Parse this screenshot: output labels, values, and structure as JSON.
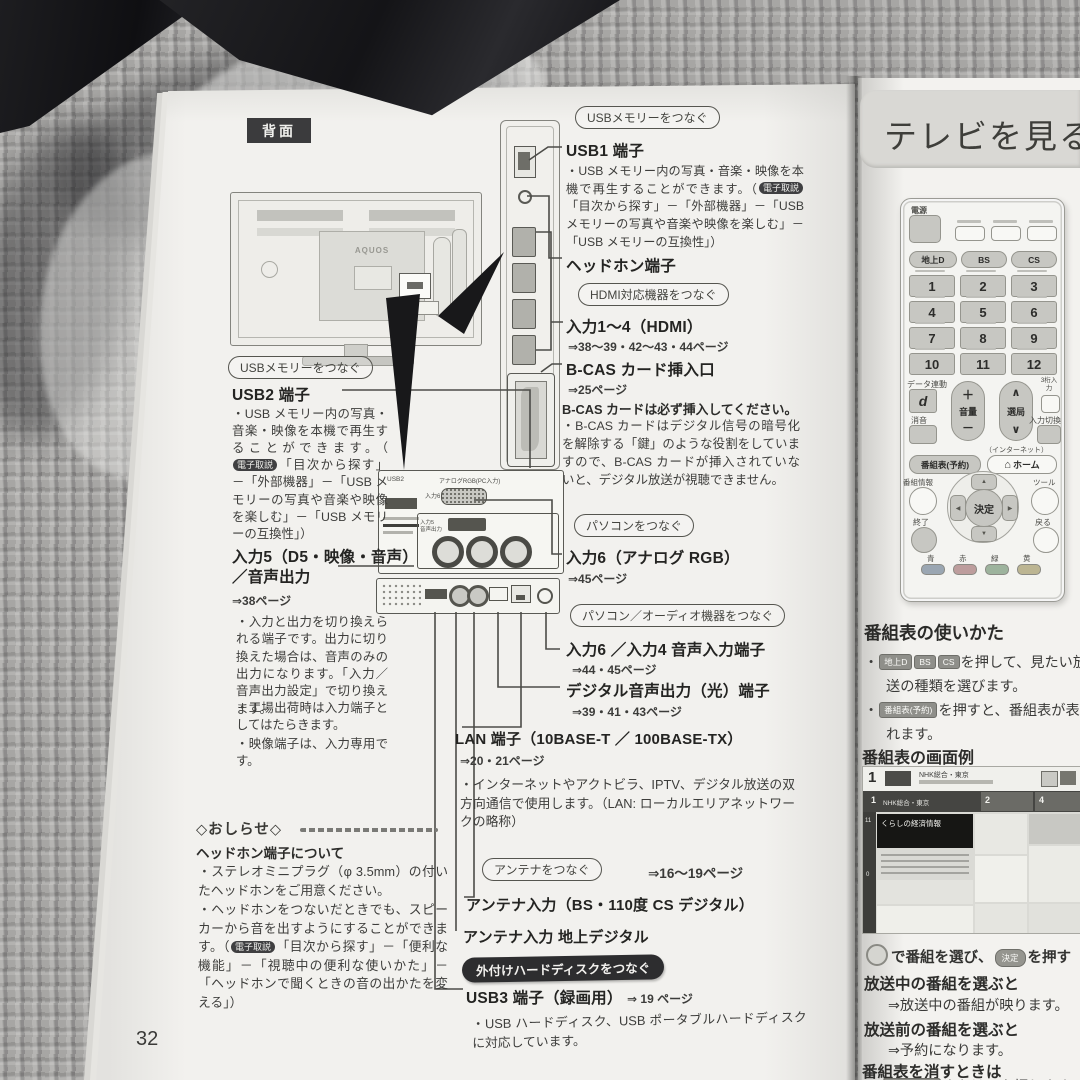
{
  "left": {
    "page_number": "32",
    "back_label": "背面",
    "tv_brand": "AQUOS",
    "ebadge": "電子取説",
    "cap_usb_right": "USBメモリーをつなぐ",
    "usb1_title": "USB1 端子",
    "usb1_pre": "・USB メモリー内の写真・音楽・映像を本機で再生することができます。（",
    "usb1_post": "「目次から探す」－「外部機器」－「USB メモリーの写真や音楽や映像を楽しむ」－「USB メモリーの互換性」）",
    "headphone_title": "ヘッドホン端子",
    "cap_hdmi": "HDMI対応機器をつなぐ",
    "hdmi_title": "入力1～4（HDMI）",
    "hdmi_pages": "⇒38～39・42～43・44ページ",
    "bcas_title": "B-CAS カード挿入口",
    "bcas_pages": "⇒25ページ",
    "bcas_warn": "B-CAS カードは必ず挿入してください。",
    "bcas_note": "・B-CAS カードはデジタル信号の暗号化を解除する「鍵」のような役割をしていますので、B-CAS カードが挿入されていないと、デジタル放送が視聴できません。",
    "cap_pc": "パソコンをつなぐ",
    "in6rgb_title": "入力6（アナログ RGB）",
    "in6rgb_pages": "⇒45ページ",
    "cap_pc_audio": "パソコン／オーディオ機器をつなぐ",
    "in6audio_title": "入力6 ／入力4 音声入力端子",
    "in6audio_pages": "⇒44・45ページ",
    "dig_title": "デジタル音声出力（光）端子",
    "dig_pages": "⇒39・41・43ページ",
    "lan_title": "LAN 端子（10BASE-T ／ 100BASE-TX）",
    "lan_pages": "⇒20・21ページ",
    "lan_note": "・インターネットやアクトビラ、IPTV、デジタル放送の双方向通信で使用します。（LAN: ローカルエリアネットワークの略称）",
    "cap_antenna": "アンテナをつなぐ",
    "antenna_pages": "⇒16～19ページ",
    "antenna_bs": "アンテナ入力（BS・110度 CS デジタル）",
    "antenna_ground": "アンテナ入力 地上デジタル",
    "cap_hdd": "外付けハードディスクをつなぐ",
    "usb3_title": "USB3 端子（録画用）",
    "usb3_pages": "⇒ 19 ページ",
    "usb3_note": "・USB ハードディスク、USB ポータブルハードディスクに対応しています。",
    "cap_usb_left": "USBメモリーをつなぐ",
    "usb2_title": "USB2 端子",
    "usb2_pre": "・USB メモリー内の写真・音楽・映像を本機で再生することができます。（",
    "usb2_post": "「目次から探す」－「外部機器」－「USB メモリーの写真や音楽や映像を楽しむ」－「USB メモリーの互換性」）",
    "in5_title": "入力5（D5・映像・音声）／音声出力",
    "in5_pages": "⇒38ページ",
    "in5_note1": "・入力と出力を切り換えられる端子です。出力に切り換えた場合は、音声のみの出力になります。「入力／音声出力設定」で切り換えます。",
    "in5_note2": "・工場出荷時は入力端子としてはたらきます。",
    "in5_note3": "・映像端子は、入力専用です。",
    "notice_title": "◇おしらせ◇",
    "notice_sub": "ヘッドホン端子について",
    "notice_1": "・ステレオミニプラグ（φ 3.5mm）の付いたヘッドホンをご用意ください。",
    "notice_2_pre": "・ヘッドホンをつないだときでも、スピーカーから音を出すようにすることができます。（",
    "notice_2_post": "「目次から探す」－「便利な機能」－「視聴中の便利な使いかた」－「ヘッドホンで聞くときの音の出かたを変える」）",
    "panel_usb2": "USB2",
    "panel_rgb": "アナログRGB(PC入力)",
    "panel_in6": "入力6",
    "panel_in5": "入力5",
    "panel_out": "音声出力"
  },
  "right": {
    "chapter": "テレビを見る",
    "remote": {
      "power": "電源",
      "bands": [
        "地上D",
        "BS",
        "CS"
      ],
      "numbers": [
        "1",
        "2",
        "3",
        "4",
        "5",
        "6",
        "7",
        "8",
        "9",
        "10",
        "11",
        "12"
      ],
      "data_link": "データ連動",
      "d": "d",
      "mute": "消音",
      "volume": "音量",
      "channel": "選局",
      "digit3": "3桁入力",
      "input_switch": "入力切換",
      "internet": "（インターネット）",
      "epg": "番組表(予約)",
      "home": "ホーム",
      "home_icon": "⌂",
      "info": "番組情報",
      "tools": "ツール",
      "enter": "決定",
      "exit": "終了",
      "back": "戻る",
      "colors": [
        "青",
        "赤",
        "緑",
        "黄"
      ],
      "plus": "＋",
      "minus": "－",
      "up": "∧",
      "down": "∨"
    },
    "guide": {
      "title": "番組表の使いかた",
      "bullet": "・",
      "s1_line1": "を押して、見たい放",
      "s1_line2": "送の種類を選びます。",
      "s2_line1": "を押すと、番組表が表示さ",
      "s2_line2": "れます。",
      "example": "番組表の画面例",
      "select_mid": "で番組を選び、",
      "select_end": "を押す",
      "onair": "放送中の番組を選ぶと",
      "onair_r": "⇒放送中の番組が映ります。",
      "pre": "放送前の番組を選ぶと",
      "pre_r": "⇒予約になります。",
      "erase": "番組表を消すときは",
      "erase_mid": "または",
      "erase_end": "を押します。"
    },
    "epg_screen": {
      "ch": "1",
      "station": "NHK総合・東京",
      "highlight": "くらしの経済情報",
      "col2": "2",
      "col3": "4"
    }
  }
}
